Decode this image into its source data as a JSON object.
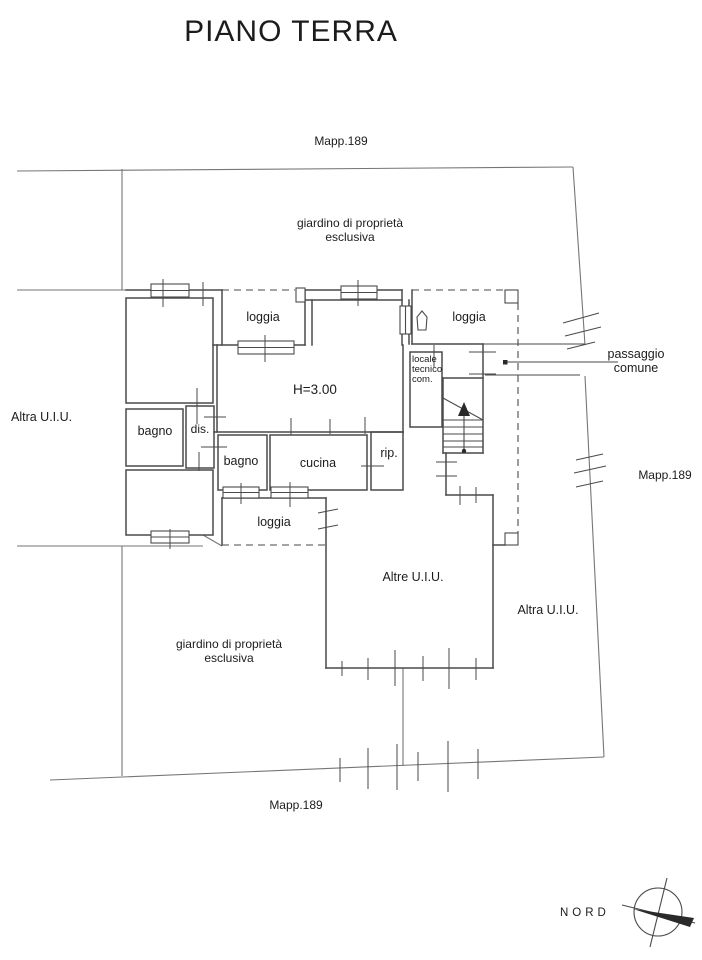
{
  "title": "PIANO TERRA",
  "parcel_labels": {
    "top": "Mapp.189",
    "right": "Mapp.189",
    "bottom": "Mapp.189"
  },
  "area_labels": {
    "garden_top_line1": "giardino di proprietà",
    "garden_top_line2": "esclusiva",
    "garden_bottom_line1": "giardino di proprietà",
    "garden_bottom_line2": "esclusiva",
    "other_unit_left": "Altra U.I.U.",
    "other_unit_right": "Altra U.I.U.",
    "other_units_center": "Altre U.I.U.",
    "passage_line1": "passaggio",
    "passage_line2": "comune"
  },
  "room_labels": {
    "loggia_top_left": "loggia",
    "loggia_top_right": "loggia",
    "loggia_bottom": "loggia",
    "bagno_left": "bagno",
    "bagno_inner": "bagno",
    "dis": "dis.",
    "cucina": "cucina",
    "rip": "rip.",
    "locale_tecnico_line1": "locale",
    "locale_tecnico_line2": "tecnico",
    "locale_tecnico_line3": "com.",
    "height_annotation": "H=3.00"
  },
  "compass": {
    "label": "NORD"
  },
  "colors": {
    "wall_line": "#4a4a4a",
    "lot_line": "#767676",
    "text": "#1c1c1c",
    "background": "#ffffff"
  }
}
